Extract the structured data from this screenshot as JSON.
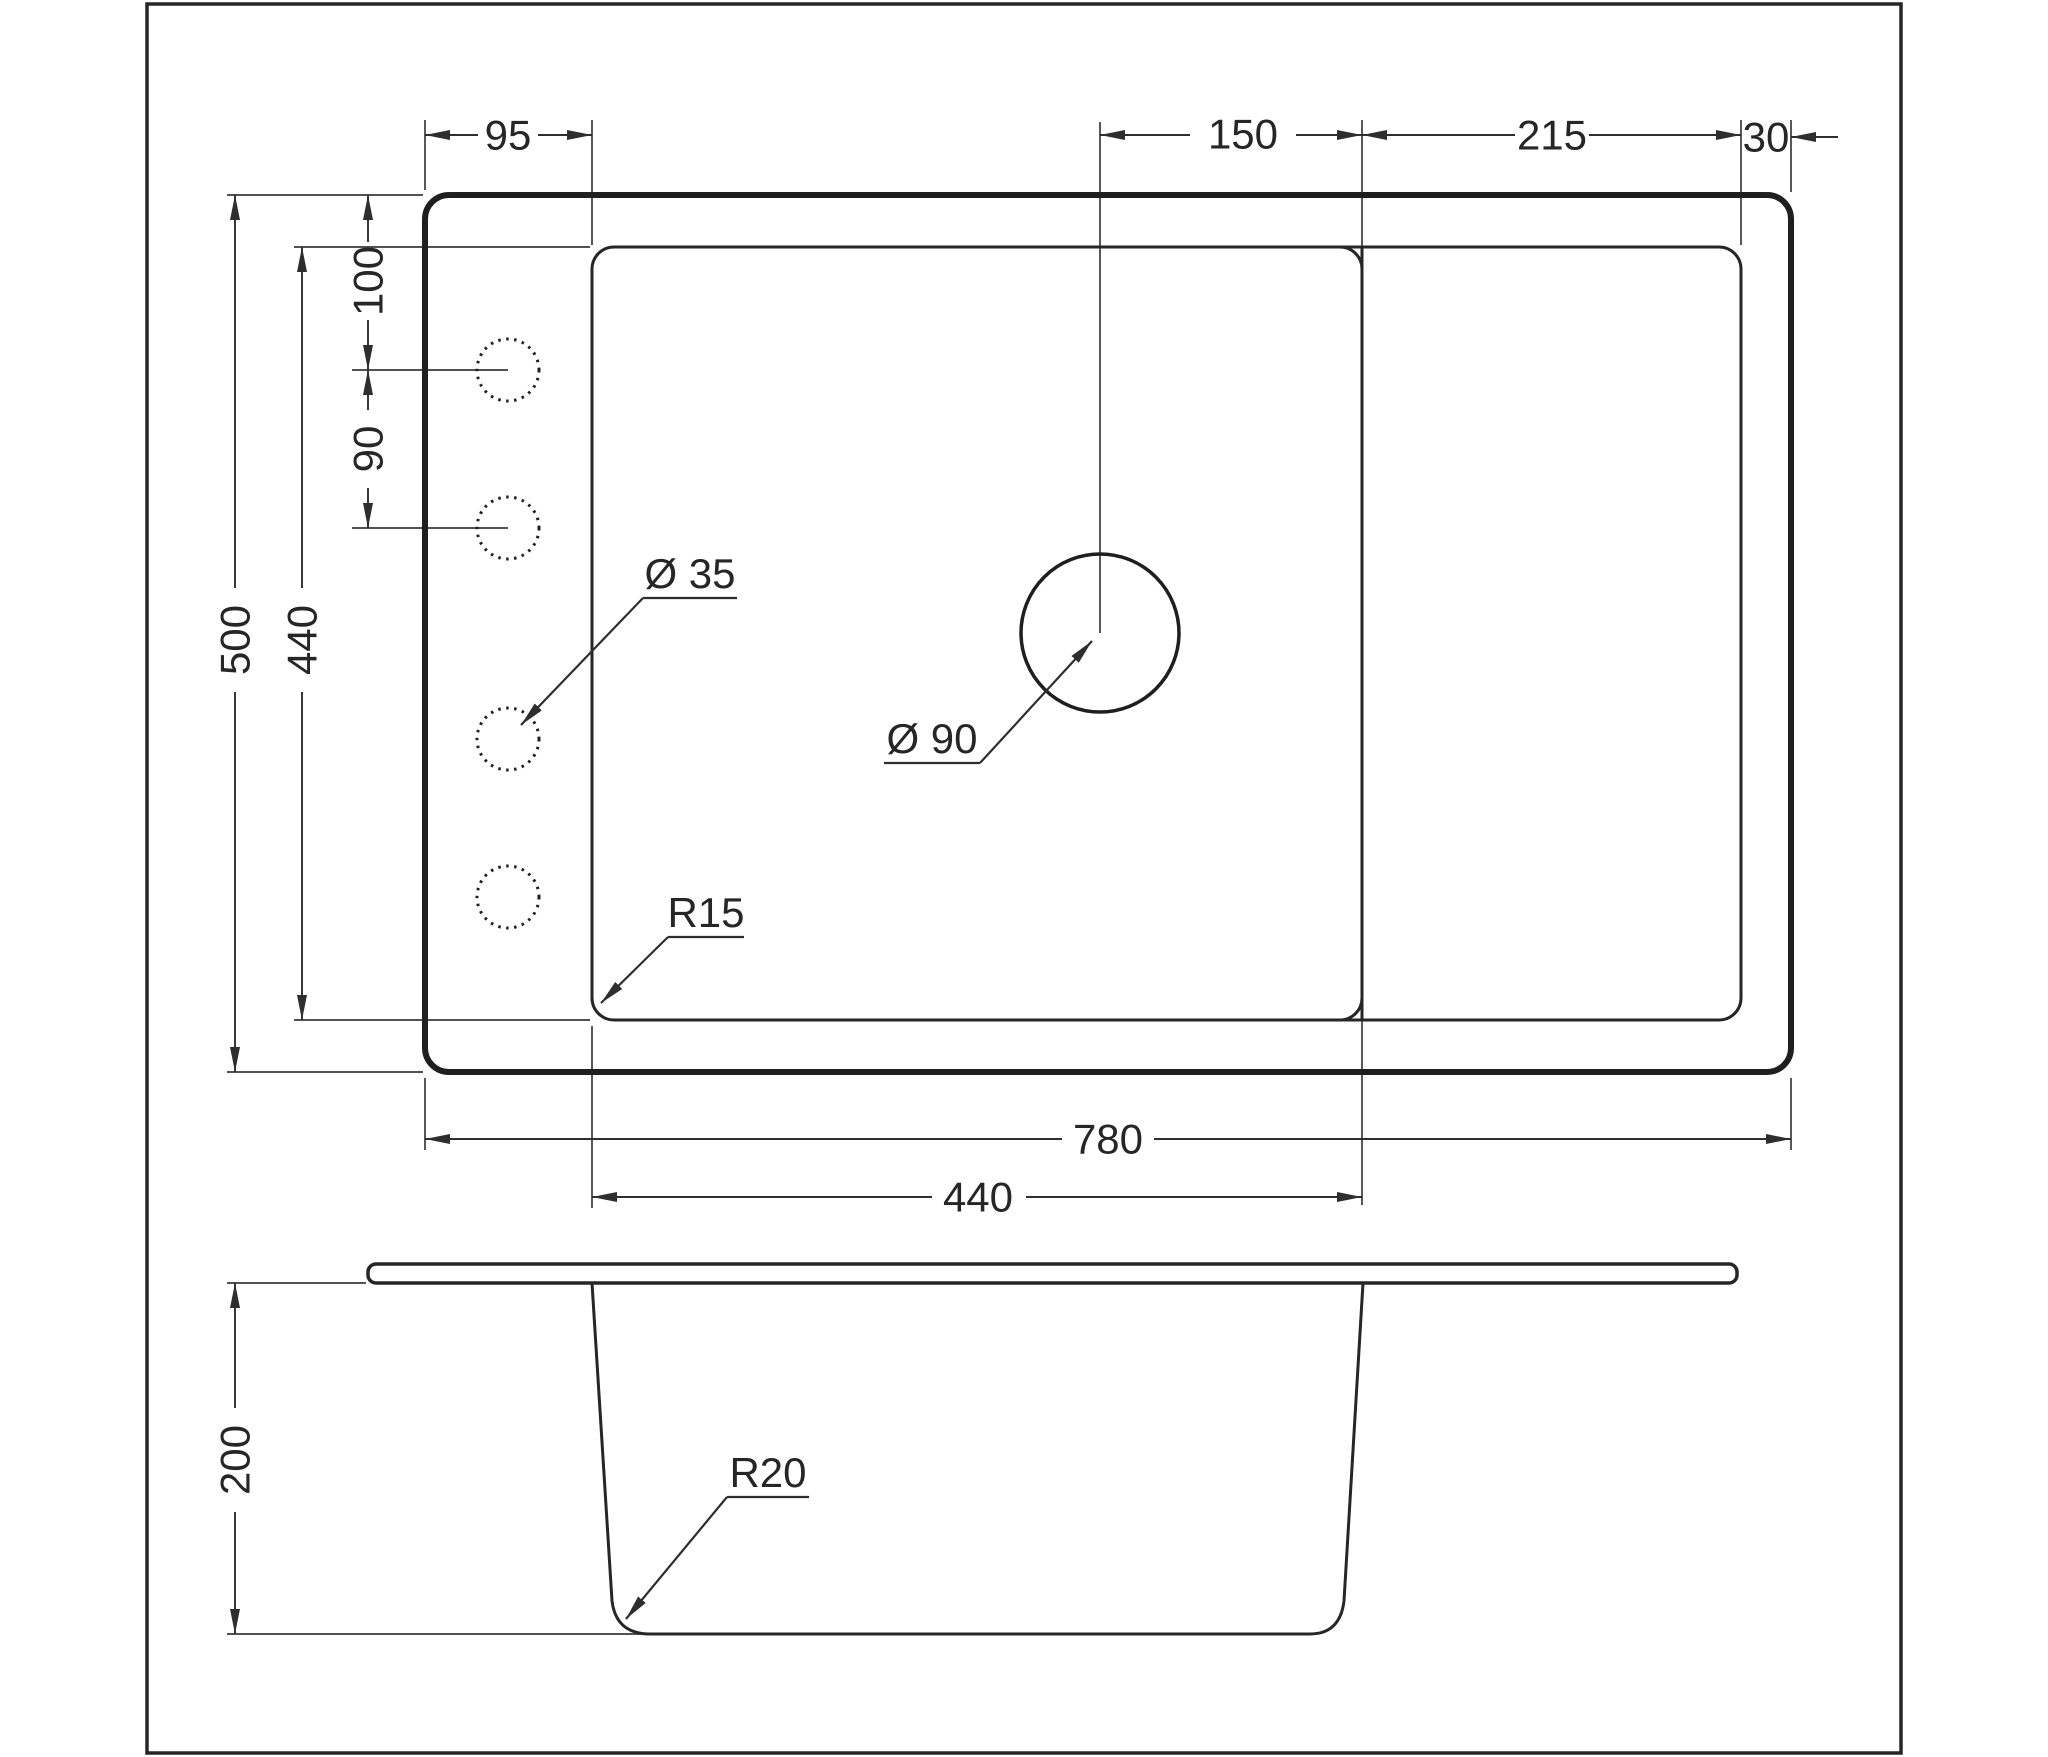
{
  "drawing": {
    "type": "technical-dimension-drawing",
    "subject": "kitchen sink — top view and side section view",
    "units": "mm"
  },
  "colors": {
    "line": "#262626",
    "text": "#262626",
    "highlight": "#3c6e9f",
    "background": "#ffffff"
  },
  "top_view": {
    "dim_left_offset": "95",
    "dim_faucet_offset": "150",
    "dim_drainboard": "215",
    "dim_right_edge": "30",
    "dim_hole_top": "100",
    "dim_hole_spacing": "90",
    "dim_overall_depth": "500",
    "dim_bowl_depth": "440",
    "dim_overall_width": "780",
    "dim_bowl_width": "440",
    "callout_hole_diameter": "Ø 35",
    "callout_drain_diameter": "Ø 90",
    "callout_corner_radius": "R15"
  },
  "side_view": {
    "dim_depth": "200",
    "callout_bottom_radius": "R20"
  }
}
